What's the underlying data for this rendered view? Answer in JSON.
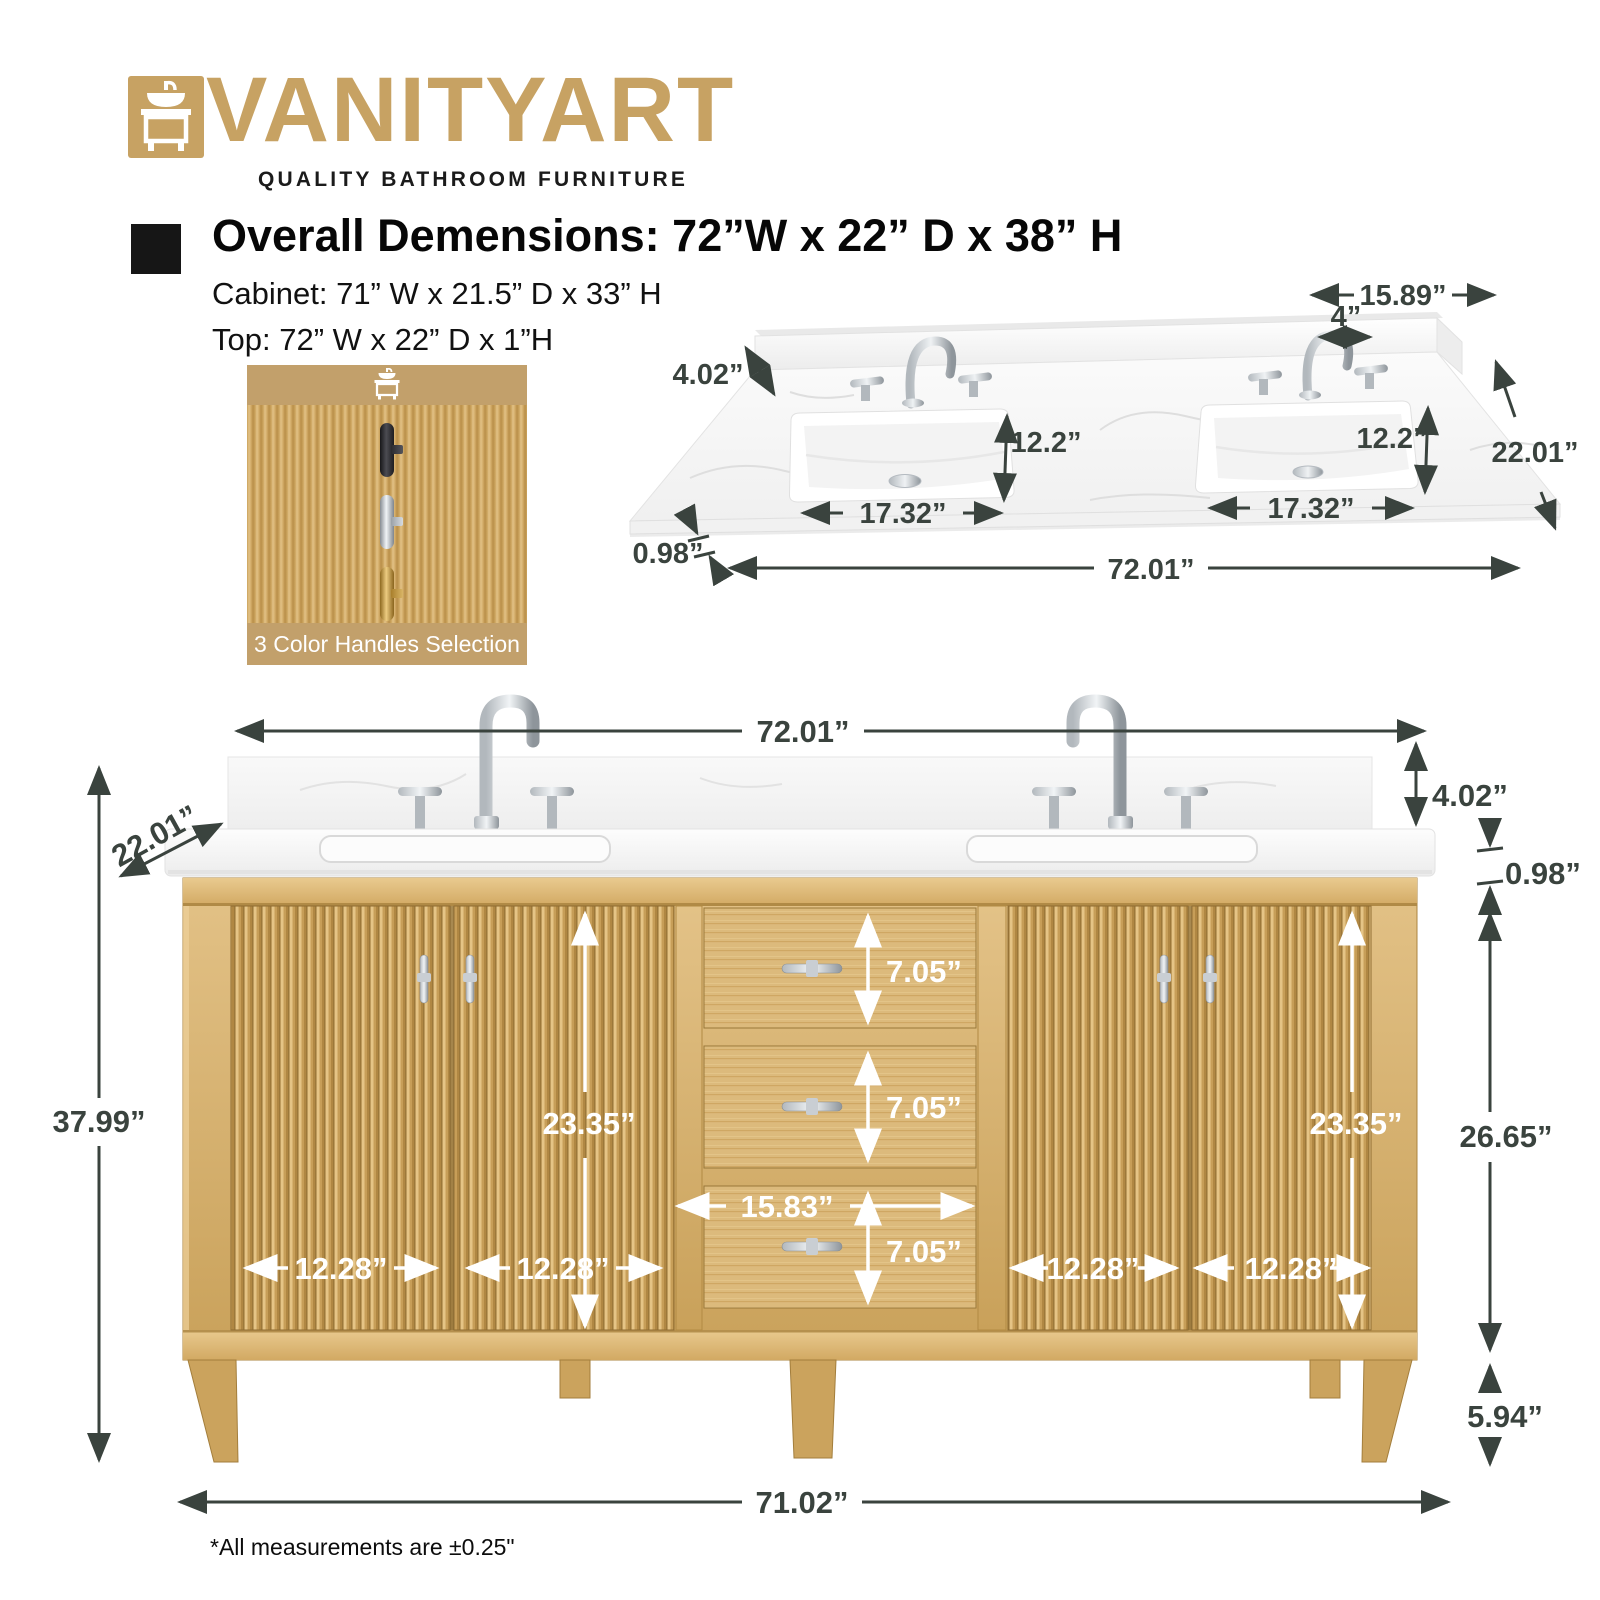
{
  "brand": {
    "name": "VANITYART",
    "tagline": "QUALITY BATHROOM FURNITURE"
  },
  "header": {
    "overall": "Overall Demensions: 72”W x 22” D x 38” H",
    "cabinet": "Cabinet: 71” W x 21.5” D x 33” H",
    "top": "Top: 72” W x 22” D x 1”H"
  },
  "handles": {
    "caption": "3 Color Handles Selection",
    "options": [
      "black",
      "chrome",
      "gold"
    ]
  },
  "top_view": {
    "faucet_span": "15.89”",
    "hole_spacing": "4”",
    "backsplash_height": "4.02”",
    "sink_depth_left": "12.2”",
    "sink_depth_right": "12.2”",
    "total_depth": "22.01”",
    "sink_width_left": "17.32”",
    "sink_width_right": "17.32”",
    "top_thickness": "0.98”",
    "total_width": "72.01”"
  },
  "front_view": {
    "top_width": "72.01”",
    "depth": "22.01”",
    "backsplash_height": "4.02”",
    "top_thickness": "0.98”",
    "overall_height": "37.99”",
    "cabinet_height": "26.65”",
    "leg_height": "5.94”",
    "door_height_left": "23.35”",
    "door_height_right": "23.35”",
    "drawer1_height": "7.05”",
    "drawer2_height": "7.05”",
    "drawer3_height": "7.05”",
    "drawer_width": "15.83”",
    "door1_width": "12.28”",
    "door2_width": "12.28”",
    "door3_width": "12.28”",
    "door4_width": "12.28”",
    "base_width": "71.02”"
  },
  "footnote": "*All measurements are ±0.25\""
}
